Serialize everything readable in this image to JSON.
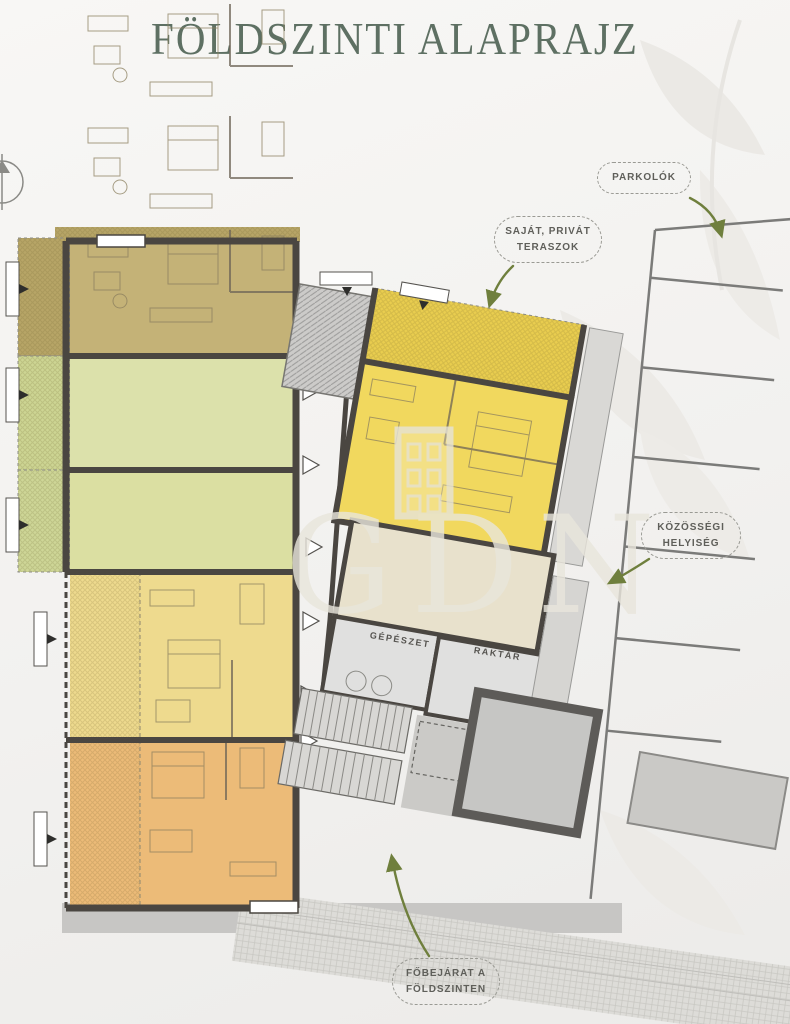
{
  "page": {
    "title": "FÖLDSZINTI ALAPRAJZ"
  },
  "callouts": {
    "parking": {
      "label": "PARKOLÓK"
    },
    "private_terraces": {
      "line1": "SAJÁT, PRIVÁT",
      "line2": "TERASZOK"
    },
    "community_room": {
      "line1": "KÖZÖSSÉGI",
      "line2": "HELYISÉG"
    },
    "main_entrance": {
      "line1": "FŐBEJÁRAT A",
      "line2": "FÖLDSZINTEN"
    }
  },
  "rooms": {
    "mechanical": "GÉPÉSZET",
    "storage": "RAKTÁR"
  },
  "watermark": {
    "text": "GDN"
  },
  "colors": {
    "title": "#5e7063",
    "callout_text": "#5f5f5a",
    "arrow_green": "#6f7f3d",
    "wall": "#4a4641",
    "unit_tan": "#c4b277",
    "unit_green": "#dce1ab",
    "unit_green_2": "#dbdfa2",
    "unit_yellow": "#eeda8e",
    "unit_orange": "#ecbb78",
    "unit_bright_yellow": "#f1d85e",
    "terrace_tan": "#b7a567",
    "terrace_green": "#cdd593",
    "terrace_green_2": "#ced697",
    "terrace_yellow": "#e7d07e",
    "terrace_orange": "#e3ab5e",
    "terrace_bright_yellow": "#e9cd4f",
    "community_room": "#e8e1cc",
    "utility_room": "#e0e0df",
    "core_square": "#c6c6c4",
    "walkway_gray": "#c7c6c4"
  }
}
